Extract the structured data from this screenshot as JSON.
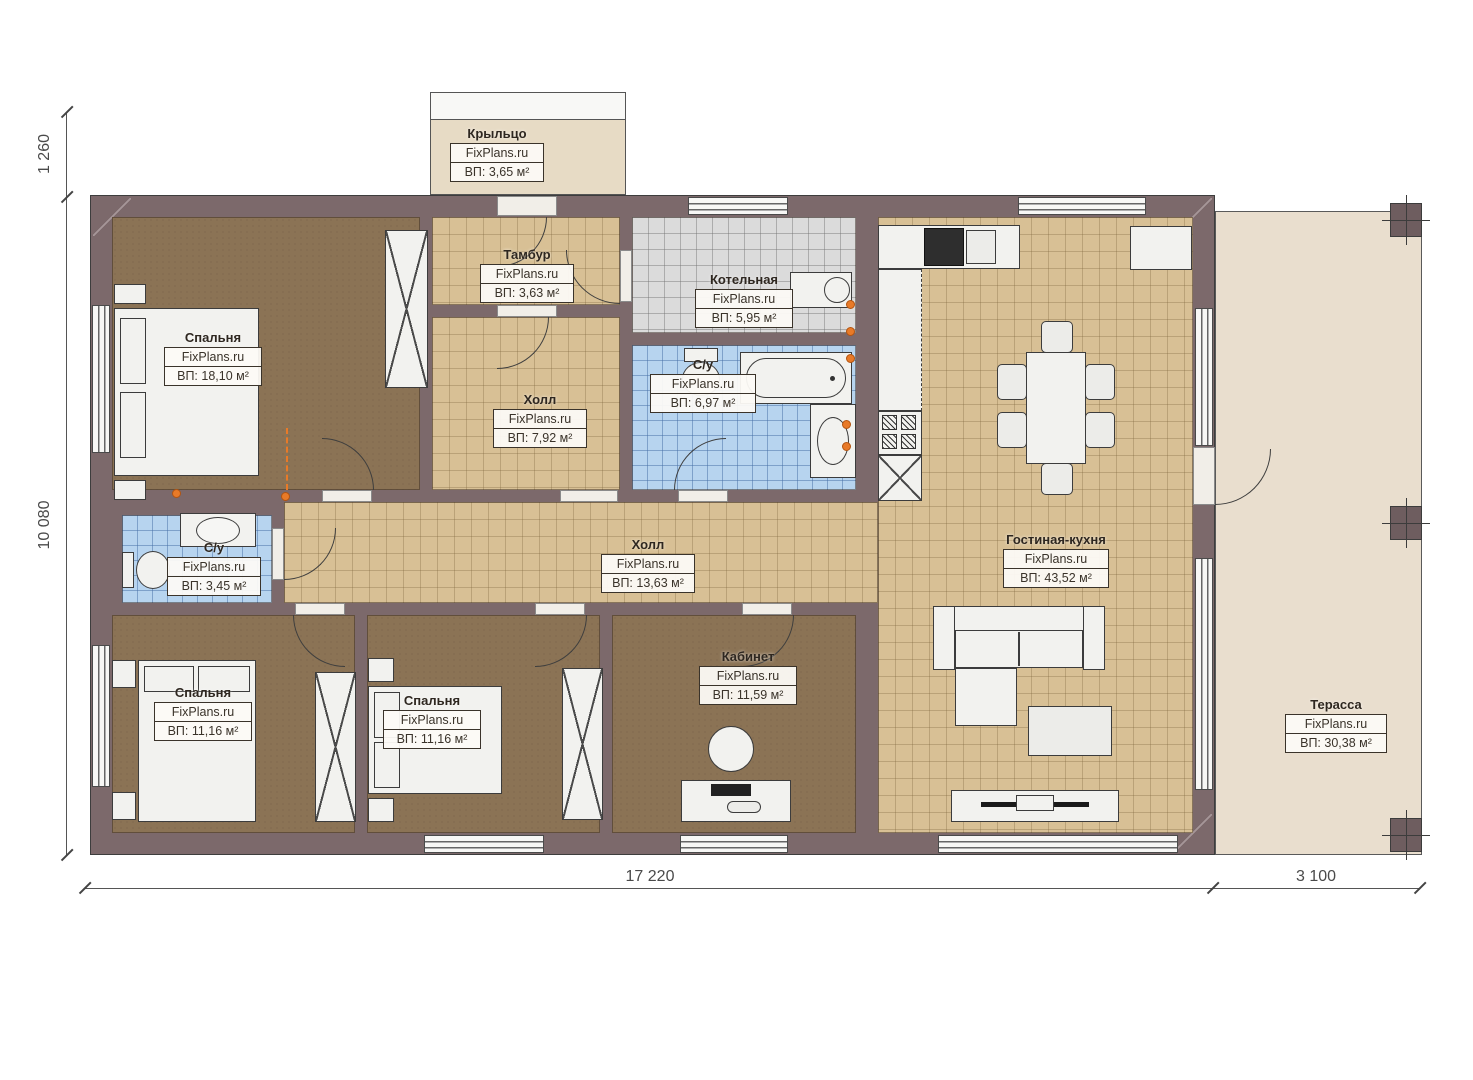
{
  "watermark": "FixPlans.ru",
  "rooms": {
    "krylco": {
      "name": "Крыльцо",
      "area": "ВП: 3,65 м²"
    },
    "tambur": {
      "name": "Тамбур",
      "area": "ВП: 3,63 м²"
    },
    "kotelnaya": {
      "name": "Котельная",
      "area": "ВП: 5,95 м²"
    },
    "bedroom1": {
      "name": "Спальня",
      "area": "ВП: 18,10 м²"
    },
    "hall792": {
      "name": "Холл",
      "area": "ВП: 7,92 м²"
    },
    "su697": {
      "name": "С/у",
      "area": "ВП: 6,97 м²"
    },
    "su345": {
      "name": "С/у",
      "area": "ВП: 3,45 м²"
    },
    "hall1363": {
      "name": "Холл",
      "area": "ВП: 13,63 м²"
    },
    "bedroom2": {
      "name": "Спальня",
      "area": "ВП: 11,16 м²"
    },
    "bedroom3": {
      "name": "Спальня",
      "area": "ВП: 11,16 м²"
    },
    "kabinet": {
      "name": "Кабинет",
      "area": "ВП: 11,59 м²"
    },
    "living": {
      "name": "Гостиная-кухня",
      "area": "ВП: 43,52 м²"
    },
    "terrace": {
      "name": "Терасса",
      "area": "ВП: 30,38 м²"
    }
  },
  "dims": {
    "porch_depth": "1 260",
    "house_depth": "10 080",
    "house_width": "17 220",
    "terrace_width": "3 100"
  },
  "colors": {
    "wall": "#7c696b",
    "bedroom_floor": "#8b7355",
    "hall_floor": "#d8c095",
    "bath_floor": "#b7d4ef",
    "boiler_floor": "#dbdbdb",
    "terrace_floor": "#e9dece",
    "accent_orange": "#e87a28"
  }
}
